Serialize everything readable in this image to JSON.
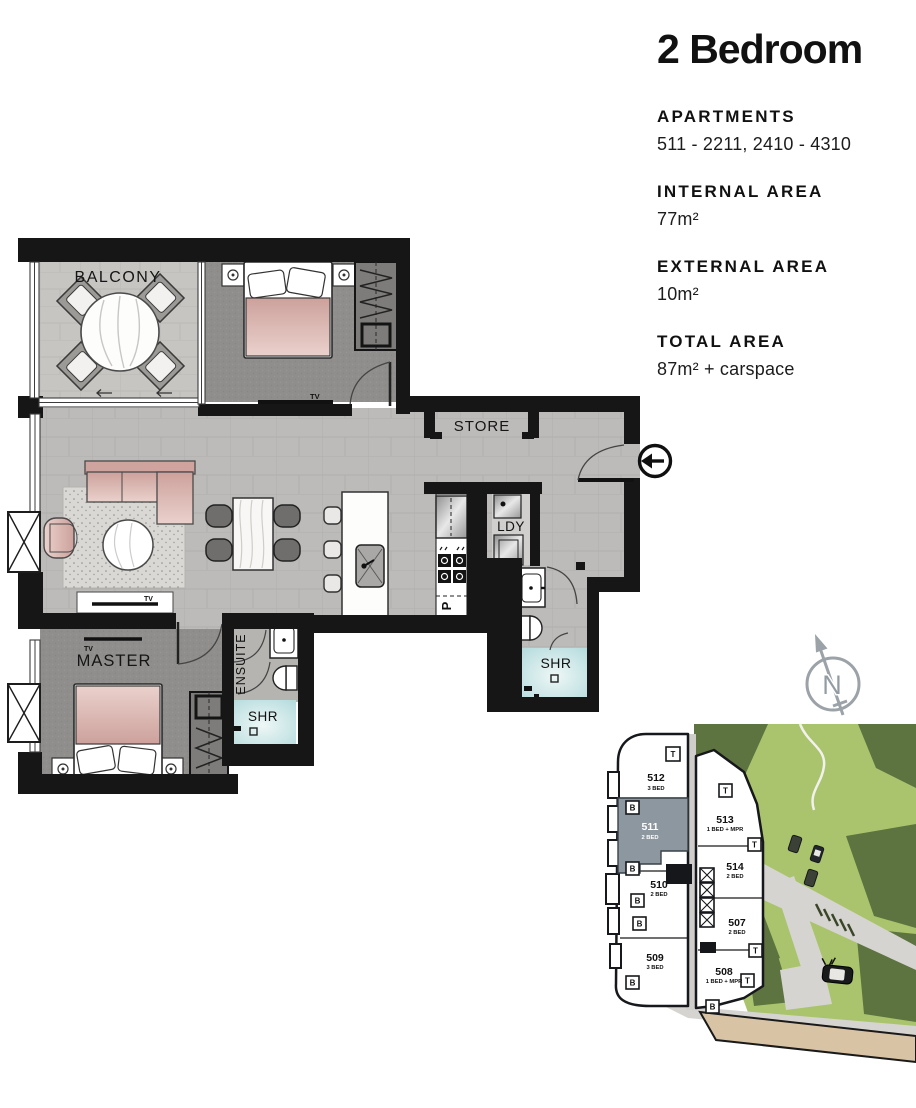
{
  "info_panel": {
    "title": "2 Bedroom",
    "sections": [
      {
        "label": "APARTMENTS",
        "value": "511 - 2211, 2410 - 4310"
      },
      {
        "label": "INTERNAL AREA",
        "value": "77m²"
      },
      {
        "label": "EXTERNAL AREA",
        "value": "10m²"
      },
      {
        "label": "TOTAL AREA",
        "value": "87m²  + carspace"
      }
    ]
  },
  "floor_plan": {
    "labels": {
      "balcony": "BALCONY",
      "store": "STORE",
      "laundry": "LDY",
      "shower_main": "SHR",
      "shower_ensuite": "SHR",
      "ensuite": "ENSUITE",
      "master": "MASTER",
      "pantry": "P",
      "tv_bedroom2": "TV",
      "tv_living": "TV",
      "tv_master": "TV"
    },
    "icons": {
      "entry_arrow": "circle-left-arrow"
    }
  },
  "compass": {
    "north_label": "N"
  },
  "key_plan": {
    "highlighted_unit": "511",
    "units": [
      {
        "id": "512",
        "type": "3 BED"
      },
      {
        "id": "511",
        "type": "2 BED"
      },
      {
        "id": "513",
        "type": "1 BED + MPR"
      },
      {
        "id": "514",
        "type": "2 BED"
      },
      {
        "id": "510",
        "type": "2 BED"
      },
      {
        "id": "507",
        "type": "2 BED"
      },
      {
        "id": "509",
        "type": "3 BED"
      },
      {
        "id": "508",
        "type": "1 BED + MPR"
      }
    ],
    "markers": {
      "balcony": "B",
      "terrace": "T"
    }
  },
  "colors": {
    "wall": "#161616",
    "floor_tile": "#bcbbb9",
    "balcony_floor": "#c6c4c1",
    "carpet": "#8f8e8c",
    "accent_pink": "#dcb2ad",
    "shower_tile": "#bfdfe1",
    "highlight_unit": "#8d97a0",
    "park_light": "#a9c46c",
    "park_dark": "#5d7340",
    "road": "#d6d4d0",
    "sand": "#d9c3a5",
    "compass": "#9ba2a8"
  }
}
